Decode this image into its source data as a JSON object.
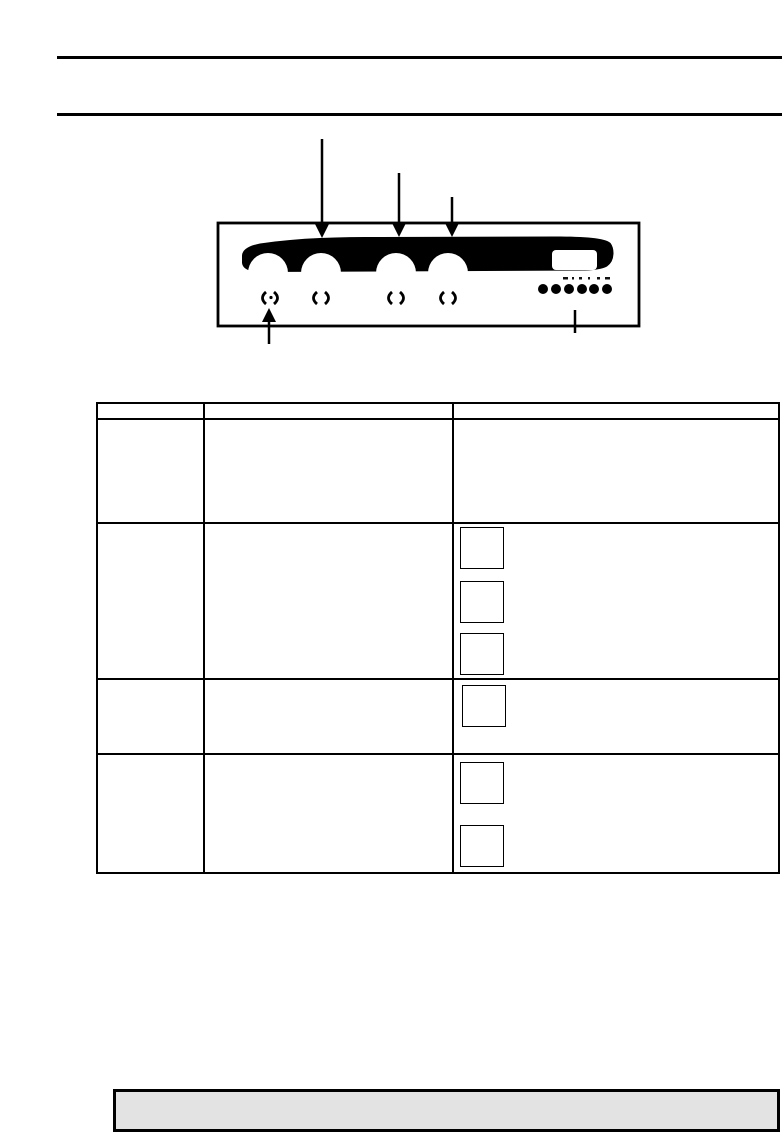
{
  "page": {
    "width": 782,
    "height": 1134,
    "bg": "#ffffff",
    "ink": "#000000"
  },
  "top_rules": [
    {
      "left": 57,
      "top": 56,
      "width": 725,
      "height": 3
    },
    {
      "left": 57,
      "top": 113,
      "width": 725,
      "height": 3
    }
  ],
  "figure": {
    "frame": {
      "x": 218,
      "y": 223,
      "w": 421,
      "h": 103,
      "stroke_w": 2.8
    },
    "band_path": "M242 256 Q242 247 260 243.5 C300 237.5 340 237 380 237 L555 236.5 C585 236.5 605 238 610.5 243 Q613.5 247 613.5 253 Q613.5 262 607 266.5 Q600 270 585 270.5 L262 272 Q243 272 242 263 Z",
    "knobs": {
      "centers_x": [
        268,
        321,
        396,
        448
      ],
      "center_y": 273,
      "radius": 20
    },
    "display_window": {
      "x": 552,
      "y": 250,
      "w": 45,
      "h": 20,
      "rx": 4
    },
    "buttons": {
      "centers_x": [
        543,
        556,
        569,
        582,
        594,
        607
      ],
      "center_y": 289,
      "radius": 5
    },
    "button_ticks": [
      {
        "x": 563,
        "w": 5
      },
      {
        "x": 572,
        "w": 2
      },
      {
        "x": 579,
        "w": 3
      },
      {
        "x": 588,
        "w": 2
      },
      {
        "x": 597,
        "w": 3
      },
      {
        "x": 605,
        "w": 5
      }
    ],
    "knob_marks": {
      "centers_x": [
        270,
        321,
        396,
        448
      ],
      "y": 298,
      "dot_on_first": true
    },
    "arrows_down": [
      {
        "x": 322,
        "top": 139,
        "tip": 238
      },
      {
        "x": 399,
        "top": 173,
        "tip": 237
      },
      {
        "x": 452,
        "top": 197,
        "tip": 237
      }
    ],
    "arrow_up": {
      "x": 269,
      "bottom": 344,
      "tip": 308
    },
    "leader": {
      "x": 575,
      "top": 310,
      "bottom": 333
    }
  },
  "table": {
    "left": 96,
    "top": 402,
    "width": 684,
    "height": 472,
    "row_lines": [
      418,
      522,
      678,
      753
    ],
    "col_lines": [
      203,
      452
    ],
    "rows": 5,
    "cols": 3,
    "icon_boxes": [
      {
        "left": 460,
        "top": 527
      },
      {
        "left": 460,
        "top": 581
      },
      {
        "left": 460,
        "top": 633
      },
      {
        "left": 462,
        "top": 685
      },
      {
        "left": 460,
        "top": 762
      },
      {
        "left": 460,
        "top": 825
      }
    ],
    "icon_box": {
      "w": 44,
      "h": 42
    }
  },
  "note_box": {
    "left": 113,
    "top": 1089,
    "width": 667,
    "height": 43,
    "fill": "#e3e3e3",
    "border": 3
  }
}
